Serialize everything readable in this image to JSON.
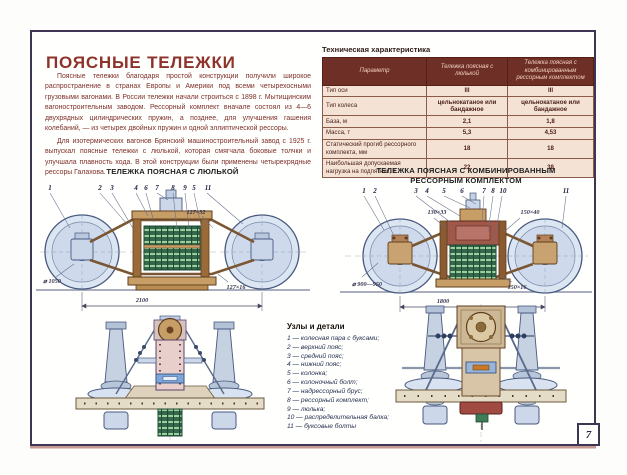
{
  "colors": {
    "accent_red": "#8e332a",
    "frame": "#3e3553",
    "table_header_bg": "#6e2f27",
    "table_body_bg": "#f4e3d5",
    "spring_green": "#35684a",
    "drawing_blue": "#d6e0ee"
  },
  "header": {
    "title": "ПОЯСНЫЕ ТЕЛЕЖКИ"
  },
  "intro": {
    "p1": "Поясные тележки благодаря простой конструкции получили широкое распространение в странах Европы и Америки под всеми четырехосными грузовыми вагонами. В России тележки начали строиться с 1898 г. Мытищинским вагоностроительным заводом. Рессорный комплект вначале состоял из 4—6 двухрядных цилиндрических пружин, а позднее, для улучшения гашения колебаний, — из четырех двойных пружин и одной эллиптической рессоры.",
    "p2": "Для изотермических вагонов Брянский машиностроительный завод с 1925 г. выпускал поясные тележки с люлькой, которая смягчала боковые толчки и улучшала плавность хода. В этой конструкции были применены четырехрядные рессоры Галахова."
  },
  "spec_table": {
    "title": "Техническая характеристика",
    "columns": [
      "Параметр",
      "Тележка поясная с люлькой",
      "Тележка поясная с комбинированным рессорным комплектом"
    ],
    "rows": [
      {
        "param": "Тип оси",
        "v1": "III",
        "v2": "III"
      },
      {
        "param": "Тип колеса",
        "v1": "цельнокатаное или бандажное",
        "v2": "цельнокатаное или бандажное"
      },
      {
        "param": "База, м",
        "v1": "2,1",
        "v2": "1,8"
      },
      {
        "param": "Масса, т",
        "v1": "5,3",
        "v2": "4,53"
      },
      {
        "param": "Статический прогиб рессорного комплекта, мм",
        "v1": "18",
        "v2": "18"
      },
      {
        "param": "Наибольшая допускаемая нагрузка на подпятник, т",
        "v1": "22",
        "v2": "38"
      }
    ]
  },
  "drawing_left": {
    "title": "ТЕЛЕЖКА ПОЯСНАЯ С ЛЮЛЬКОЙ",
    "callouts": [
      "1",
      "2",
      "3",
      "4",
      "6",
      "7",
      "8",
      "9",
      "5",
      "11"
    ],
    "dims": {
      "belt_top": "127×32",
      "wheel": "⌀ 1050",
      "belt_bottom": "127×16",
      "base": "2100"
    }
  },
  "drawing_right": {
    "title_line1": "ТЕЛЕЖКА ПОЯСНАЯ С КОМБИНИРОВАННЫМ",
    "title_line2": "РЕССОРНЫМ КОМПЛЕКТОМ",
    "callouts": [
      "1",
      "2",
      "3",
      "4",
      "5",
      "6",
      "7",
      "8",
      "10",
      "11"
    ],
    "dims": {
      "belt_top1": "130×33",
      "belt_top2": "150×40",
      "wheel": "⌀ 900—950",
      "belt_bottom": "150×16",
      "base": "1800"
    }
  },
  "parts": {
    "title": "Узлы и детали",
    "items": [
      "1 — колесная пара с буксами;",
      "2 — верхний пояс;",
      "3 — средний пояс;",
      "4 — нижний пояс;",
      "5 — колонка;",
      "6 — колоночный болт;",
      "7 — надрессорный брус;",
      "8 — рессорный комплект;",
      "9 — люлька;",
      "10 — распределительная балка;",
      "11 — буксовые болты"
    ]
  },
  "page": {
    "number": "7"
  }
}
